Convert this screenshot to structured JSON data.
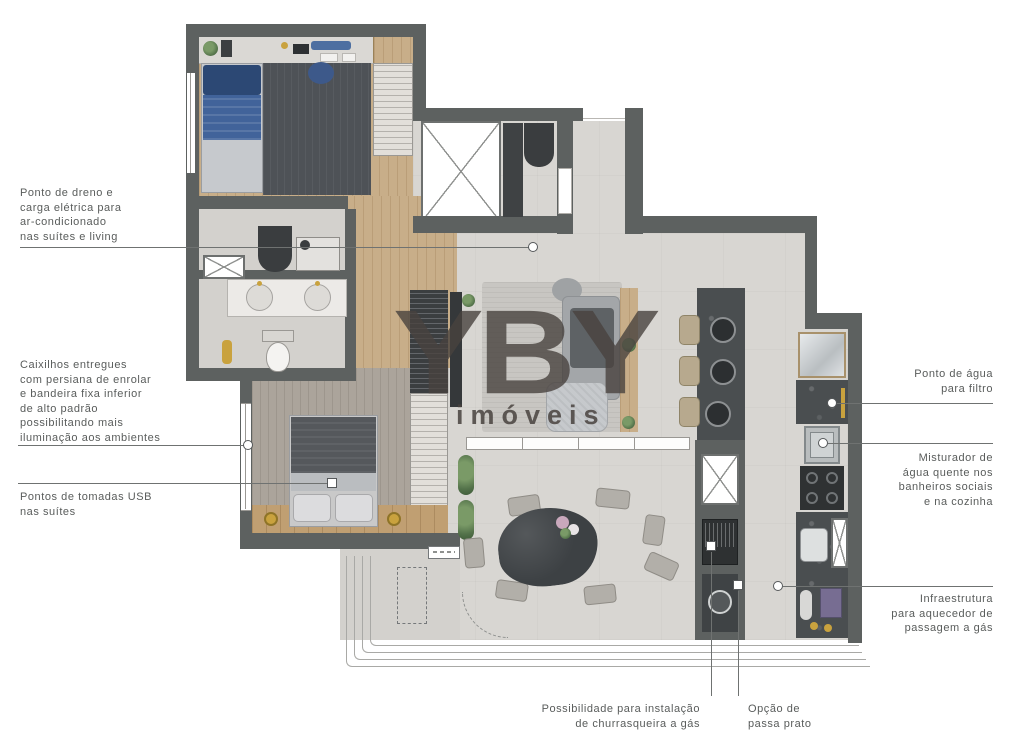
{
  "watermark": {
    "brand": "YBY",
    "subtitle": "imóveis"
  },
  "annotations": {
    "ac_drain": {
      "lines": [
        "Ponto de dreno e",
        "carga elétrica para",
        "ar-condicionado",
        "nas suítes e living"
      ]
    },
    "windows": {
      "lines": [
        "Caixilhos entregues",
        "com persiana de enrolar",
        "e bandeira fixa inferior",
        "de alto padrão",
        "possibilitando mais",
        "iluminação aos ambientes"
      ]
    },
    "usb": {
      "lines": [
        "Pontos de tomadas USB",
        "nas suítes"
      ]
    },
    "water_filter": {
      "lines": [
        "Ponto de água",
        "para filtro"
      ]
    },
    "mixer": {
      "lines": [
        "Misturador de",
        "água quente nos",
        "banheiros sociais",
        "e na cozinha"
      ]
    },
    "heater": {
      "lines": [
        "Infraestrutura",
        "para aquecedor de",
        "passagem a gás"
      ]
    },
    "barbecue": {
      "lines": [
        "Possibilidade para instalação",
        "de churrasqueira a gás"
      ]
    },
    "pass_through": {
      "lines": [
        "Opção de",
        "passa prato"
      ]
    }
  },
  "colors": {
    "wall": "#5d6160",
    "floor_tile": "#d8d6d2",
    "wood_floor": "#c8ae89",
    "stone_counter": "#4a4e50",
    "bed_blue": "#41639a",
    "accent_gold": "#c9a23e",
    "annotation_text": "#595c5b",
    "leader_line": "#6f7271",
    "watermark": "#48423e"
  }
}
